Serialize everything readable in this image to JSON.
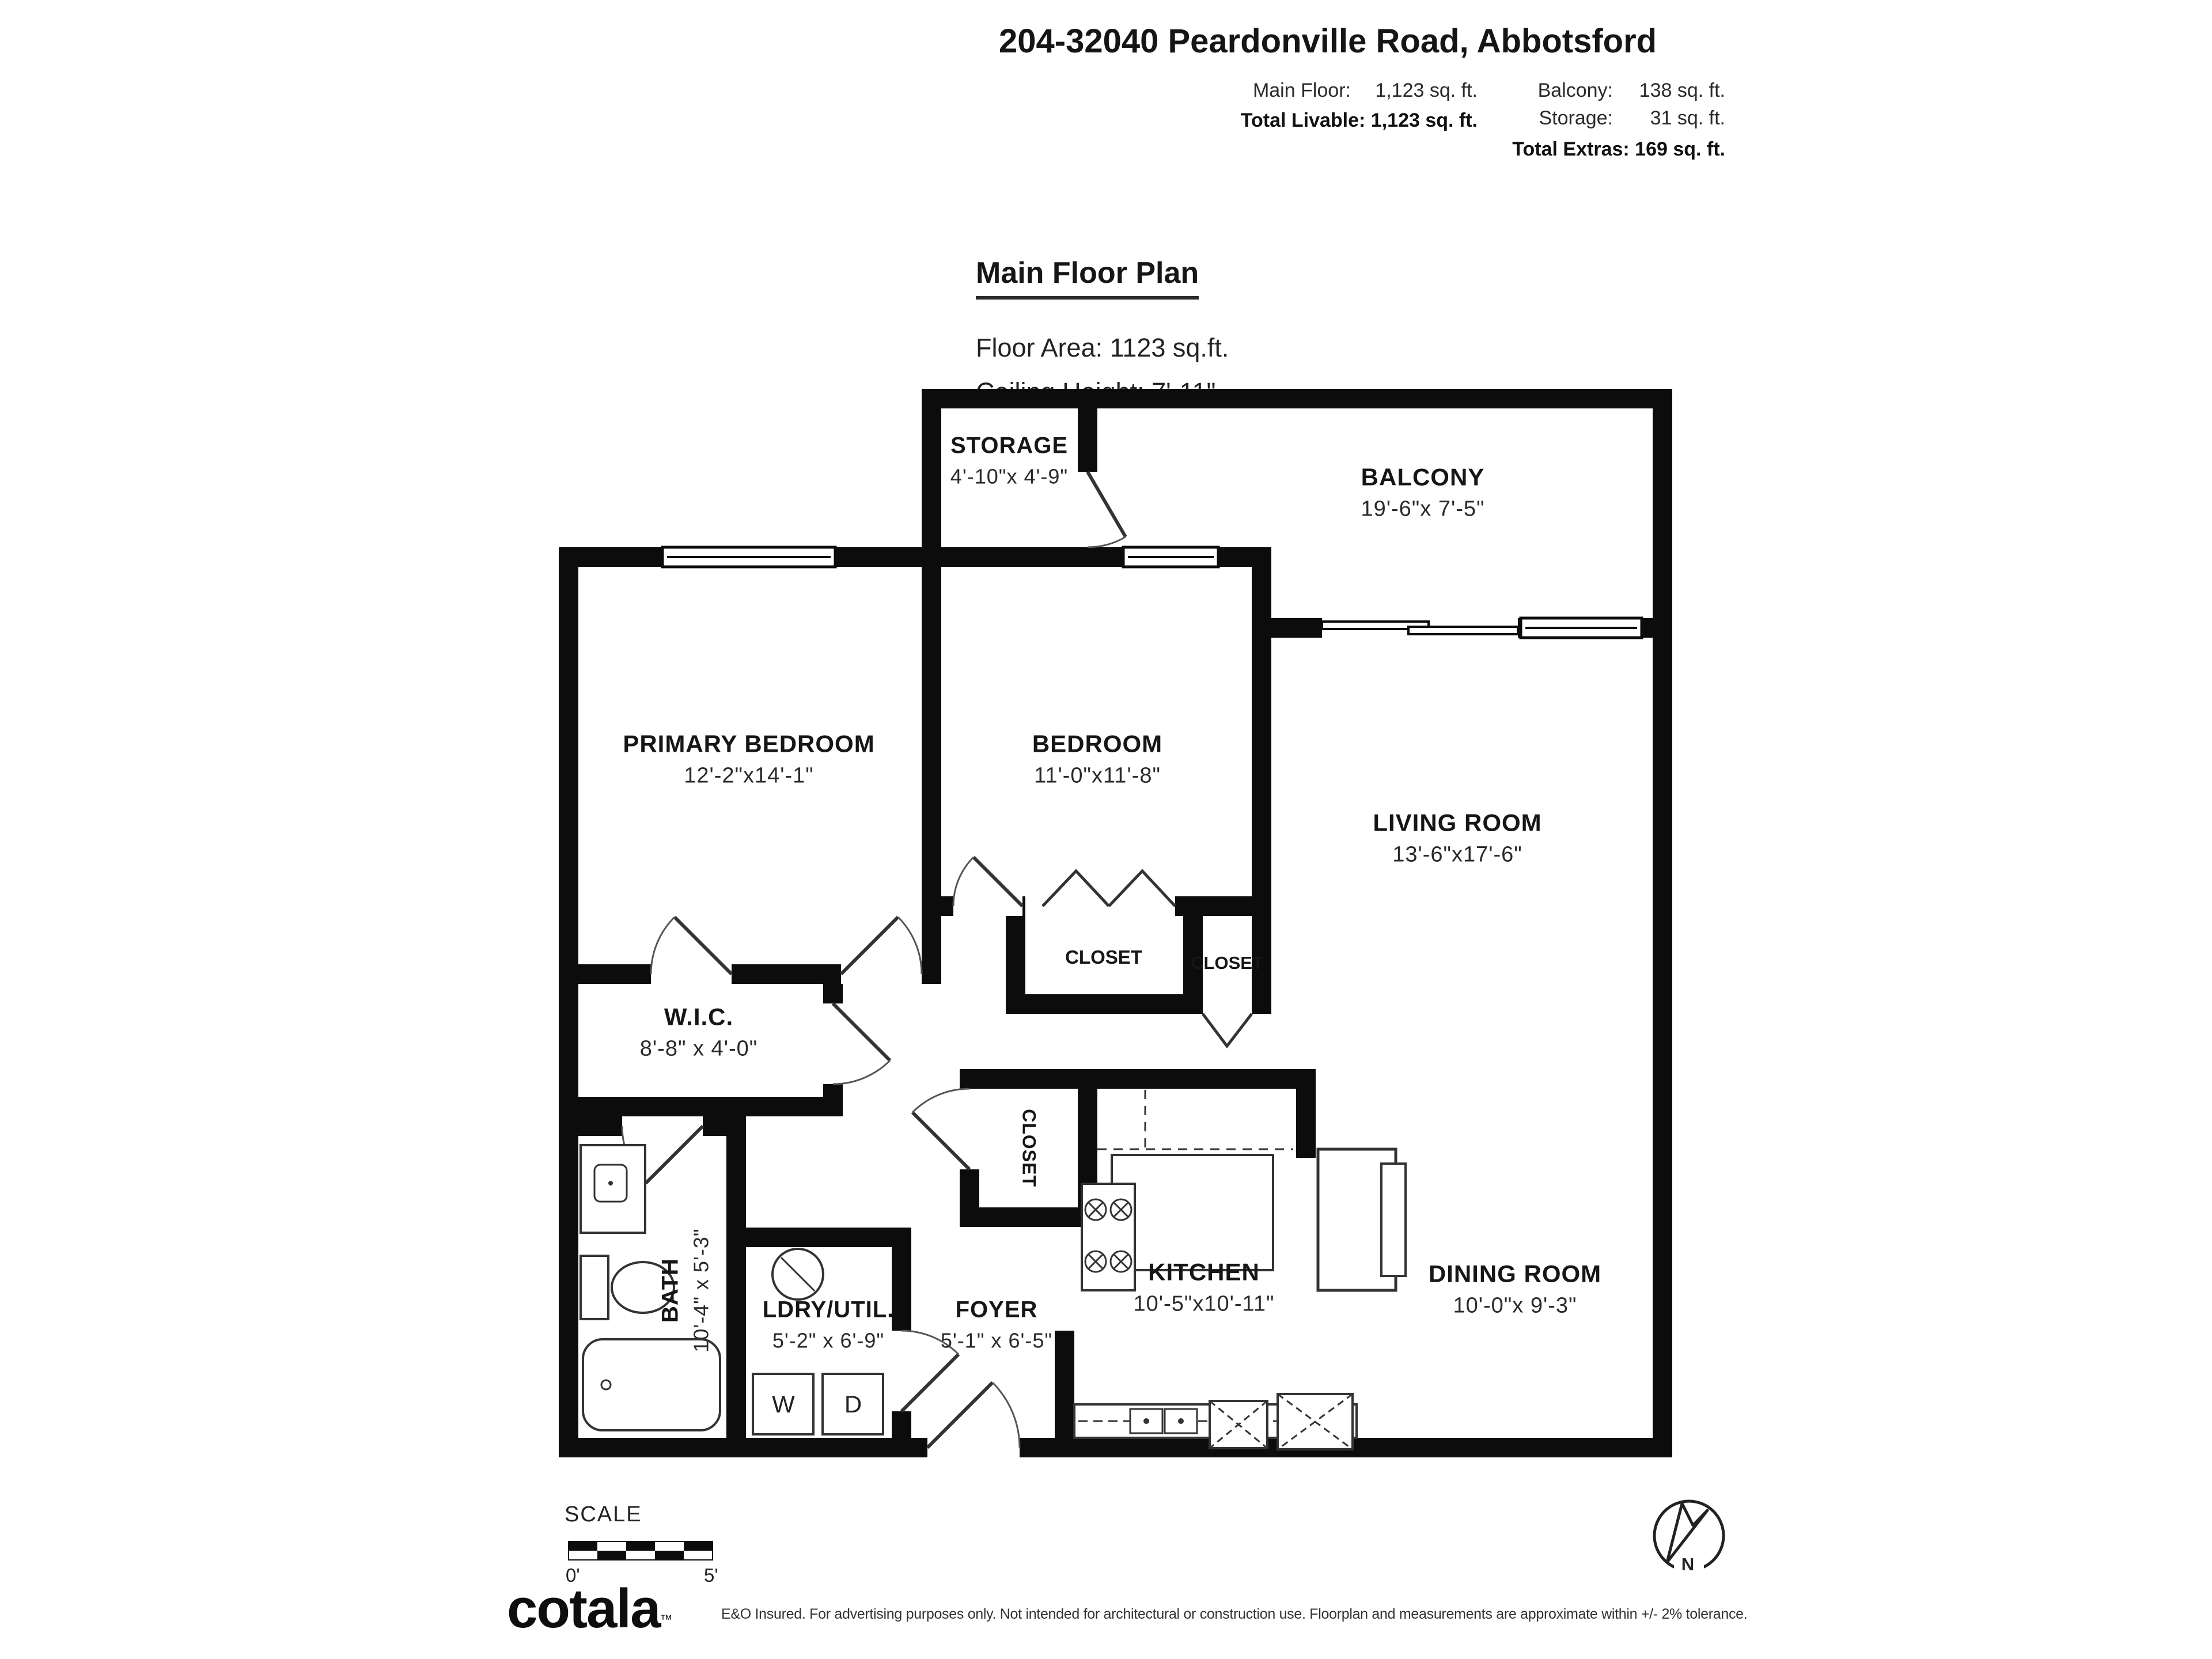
{
  "header": {
    "title": "204-32040 Peardonville Road, Abbotsford",
    "stats": {
      "main_floor_label": "Main Floor:",
      "main_floor_value": "1,123 sq. ft.",
      "total_livable": "Total Livable: 1,123 sq. ft.",
      "balcony_label": "Balcony:",
      "balcony_value": "138 sq. ft.",
      "storage_label": "Storage:",
      "storage_value": "31 sq. ft.",
      "total_extras": "Total Extras: 169 sq. ft."
    }
  },
  "plan_heading": {
    "title": "Main Floor Plan",
    "floor_area": "Floor Area: 1123 sq.ft.",
    "ceiling_height": "Ceiling Height: 7'-11\""
  },
  "rooms": {
    "storage": {
      "name": "STORAGE",
      "dims": "4'-10\"x 4'-9\""
    },
    "balcony": {
      "name": "BALCONY",
      "dims": "19'-6\"x 7'-5\""
    },
    "primary_bedroom": {
      "name": "PRIMARY BEDROOM",
      "dims": "12'-2\"x14'-1\""
    },
    "bedroom": {
      "name": "BEDROOM",
      "dims": "11'-0\"x11'-8\""
    },
    "living_room": {
      "name": "LIVING ROOM",
      "dims": "13'-6\"x17'-6\""
    },
    "closet1": {
      "name": "CLOSET"
    },
    "closet2": {
      "name": "CLOSET"
    },
    "hall_closet": {
      "name": "CLOSET"
    },
    "wic": {
      "name": "W.I.C.",
      "dims": "8'-8\" x 4'-0\""
    },
    "bath": {
      "name": "BATH",
      "dims": "10'-4\" x 5'-3\""
    },
    "laundry": {
      "name": "LDRY/UTIL.",
      "dims": "5'-2\" x 6'-9\""
    },
    "foyer": {
      "name": "FOYER",
      "dims": "5'-1\" x 6'-5\""
    },
    "kitchen": {
      "name": "KITCHEN",
      "dims": "10'-5\"x10'-11\""
    },
    "dining": {
      "name": "DINING ROOM",
      "dims": "10'-0\"x 9'-3\""
    }
  },
  "appliances": {
    "washer": "W",
    "dryer": "D"
  },
  "scale_bar": {
    "label": "SCALE",
    "start": "0'",
    "end": "5'"
  },
  "compass": {
    "north": "N"
  },
  "footer": {
    "logo": "cotala",
    "trademark": "™",
    "disclaimer": "E&O Insured. For advertising purposes only. Not intended for architectural or construction use. Floorplan and measurements are approximate within +/- 2% tolerance."
  }
}
